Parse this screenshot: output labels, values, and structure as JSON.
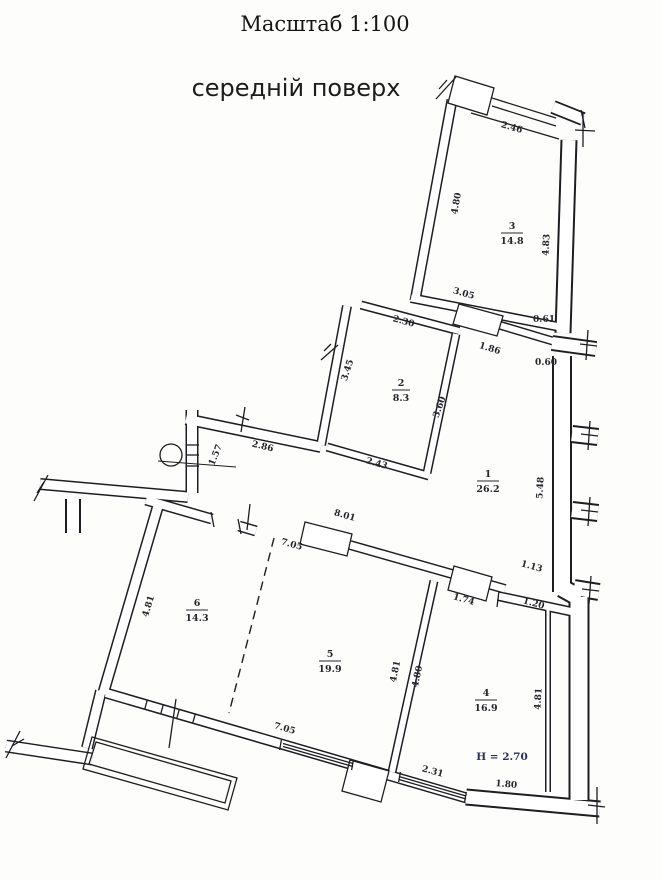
{
  "title": "Масштаб 1:100",
  "subtitle": "середній поверх",
  "plan": {
    "height_note": "H = 2.70",
    "rooms": [
      {
        "number": "1",
        "area": "26.2"
      },
      {
        "number": "2",
        "area": "8.3"
      },
      {
        "number": "3",
        "area": "14.8"
      },
      {
        "number": "4",
        "area": "16.9"
      },
      {
        "number": "5",
        "area": "19.9"
      },
      {
        "number": "6",
        "area": "14.3"
      }
    ],
    "dimensions": [
      {
        "value": "2.46"
      },
      {
        "value": "4.80"
      },
      {
        "value": "4.83"
      },
      {
        "value": "3.05"
      },
      {
        "value": "0.61"
      },
      {
        "value": "2.30"
      },
      {
        "value": "1.86"
      },
      {
        "value": "0.60"
      },
      {
        "value": "3.45"
      },
      {
        "value": "3.60"
      },
      {
        "value": "5.48"
      },
      {
        "value": "1.57"
      },
      {
        "value": "2.86"
      },
      {
        "value": "2.43"
      },
      {
        "value": "8.01"
      },
      {
        "value": "7.05"
      },
      {
        "value": "1.13"
      },
      {
        "value": "4.81"
      },
      {
        "value": "1.74"
      },
      {
        "value": "1.20"
      },
      {
        "value": "4.81"
      },
      {
        "value": "4.80"
      },
      {
        "value": "4.81"
      },
      {
        "value": "7.05"
      },
      {
        "value": "2.31"
      },
      {
        "value": "1.80"
      }
    ]
  }
}
